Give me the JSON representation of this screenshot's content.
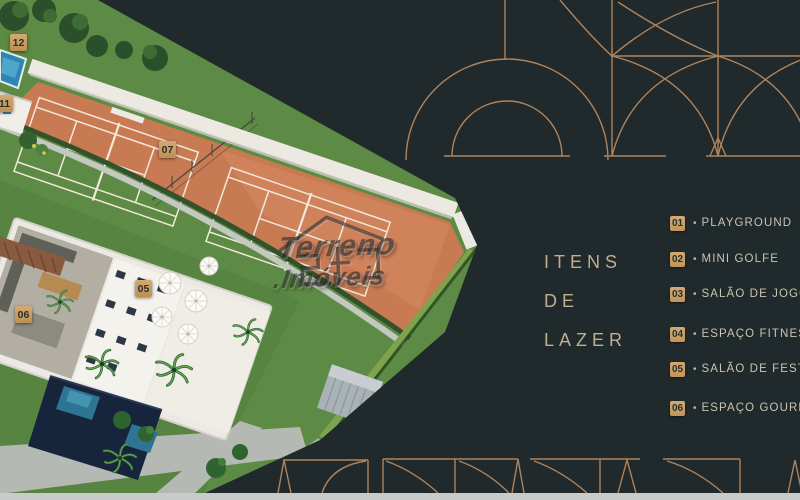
{
  "headline": {
    "line1": "ITENS",
    "line2": "DE",
    "line3": "LAZER"
  },
  "legend": {
    "bullet": "•",
    "items": [
      {
        "num": "01",
        "label": "PLAYGROUND"
      },
      {
        "num": "02",
        "label": "MINI GOLFE"
      },
      {
        "num": "03",
        "label": "SALÃO DE JOGOS"
      },
      {
        "num": "04",
        "label": "ESPAÇO FITNESS"
      },
      {
        "num": "05",
        "label": "SALÃO DE FESTAS"
      },
      {
        "num": "06",
        "label": "ESPAÇO GOURMET"
      }
    ]
  },
  "map_badges": {
    "b12": "12",
    "b11": "11",
    "b07": "07",
    "b05": "05",
    "b06": "06"
  },
  "watermark": {
    "line1": "Terreno",
    "line2": ".Imóveis"
  },
  "colors": {
    "background": "#20292c",
    "accent_copper": "#bd8c60",
    "badge": "#c79e63",
    "headline_text": "#c0ae8e",
    "legend_text": "#cbc4b2",
    "clay_court": "#c87a52",
    "lawn": "#5d8a44",
    "bottom_bar": "#c9cbca"
  }
}
